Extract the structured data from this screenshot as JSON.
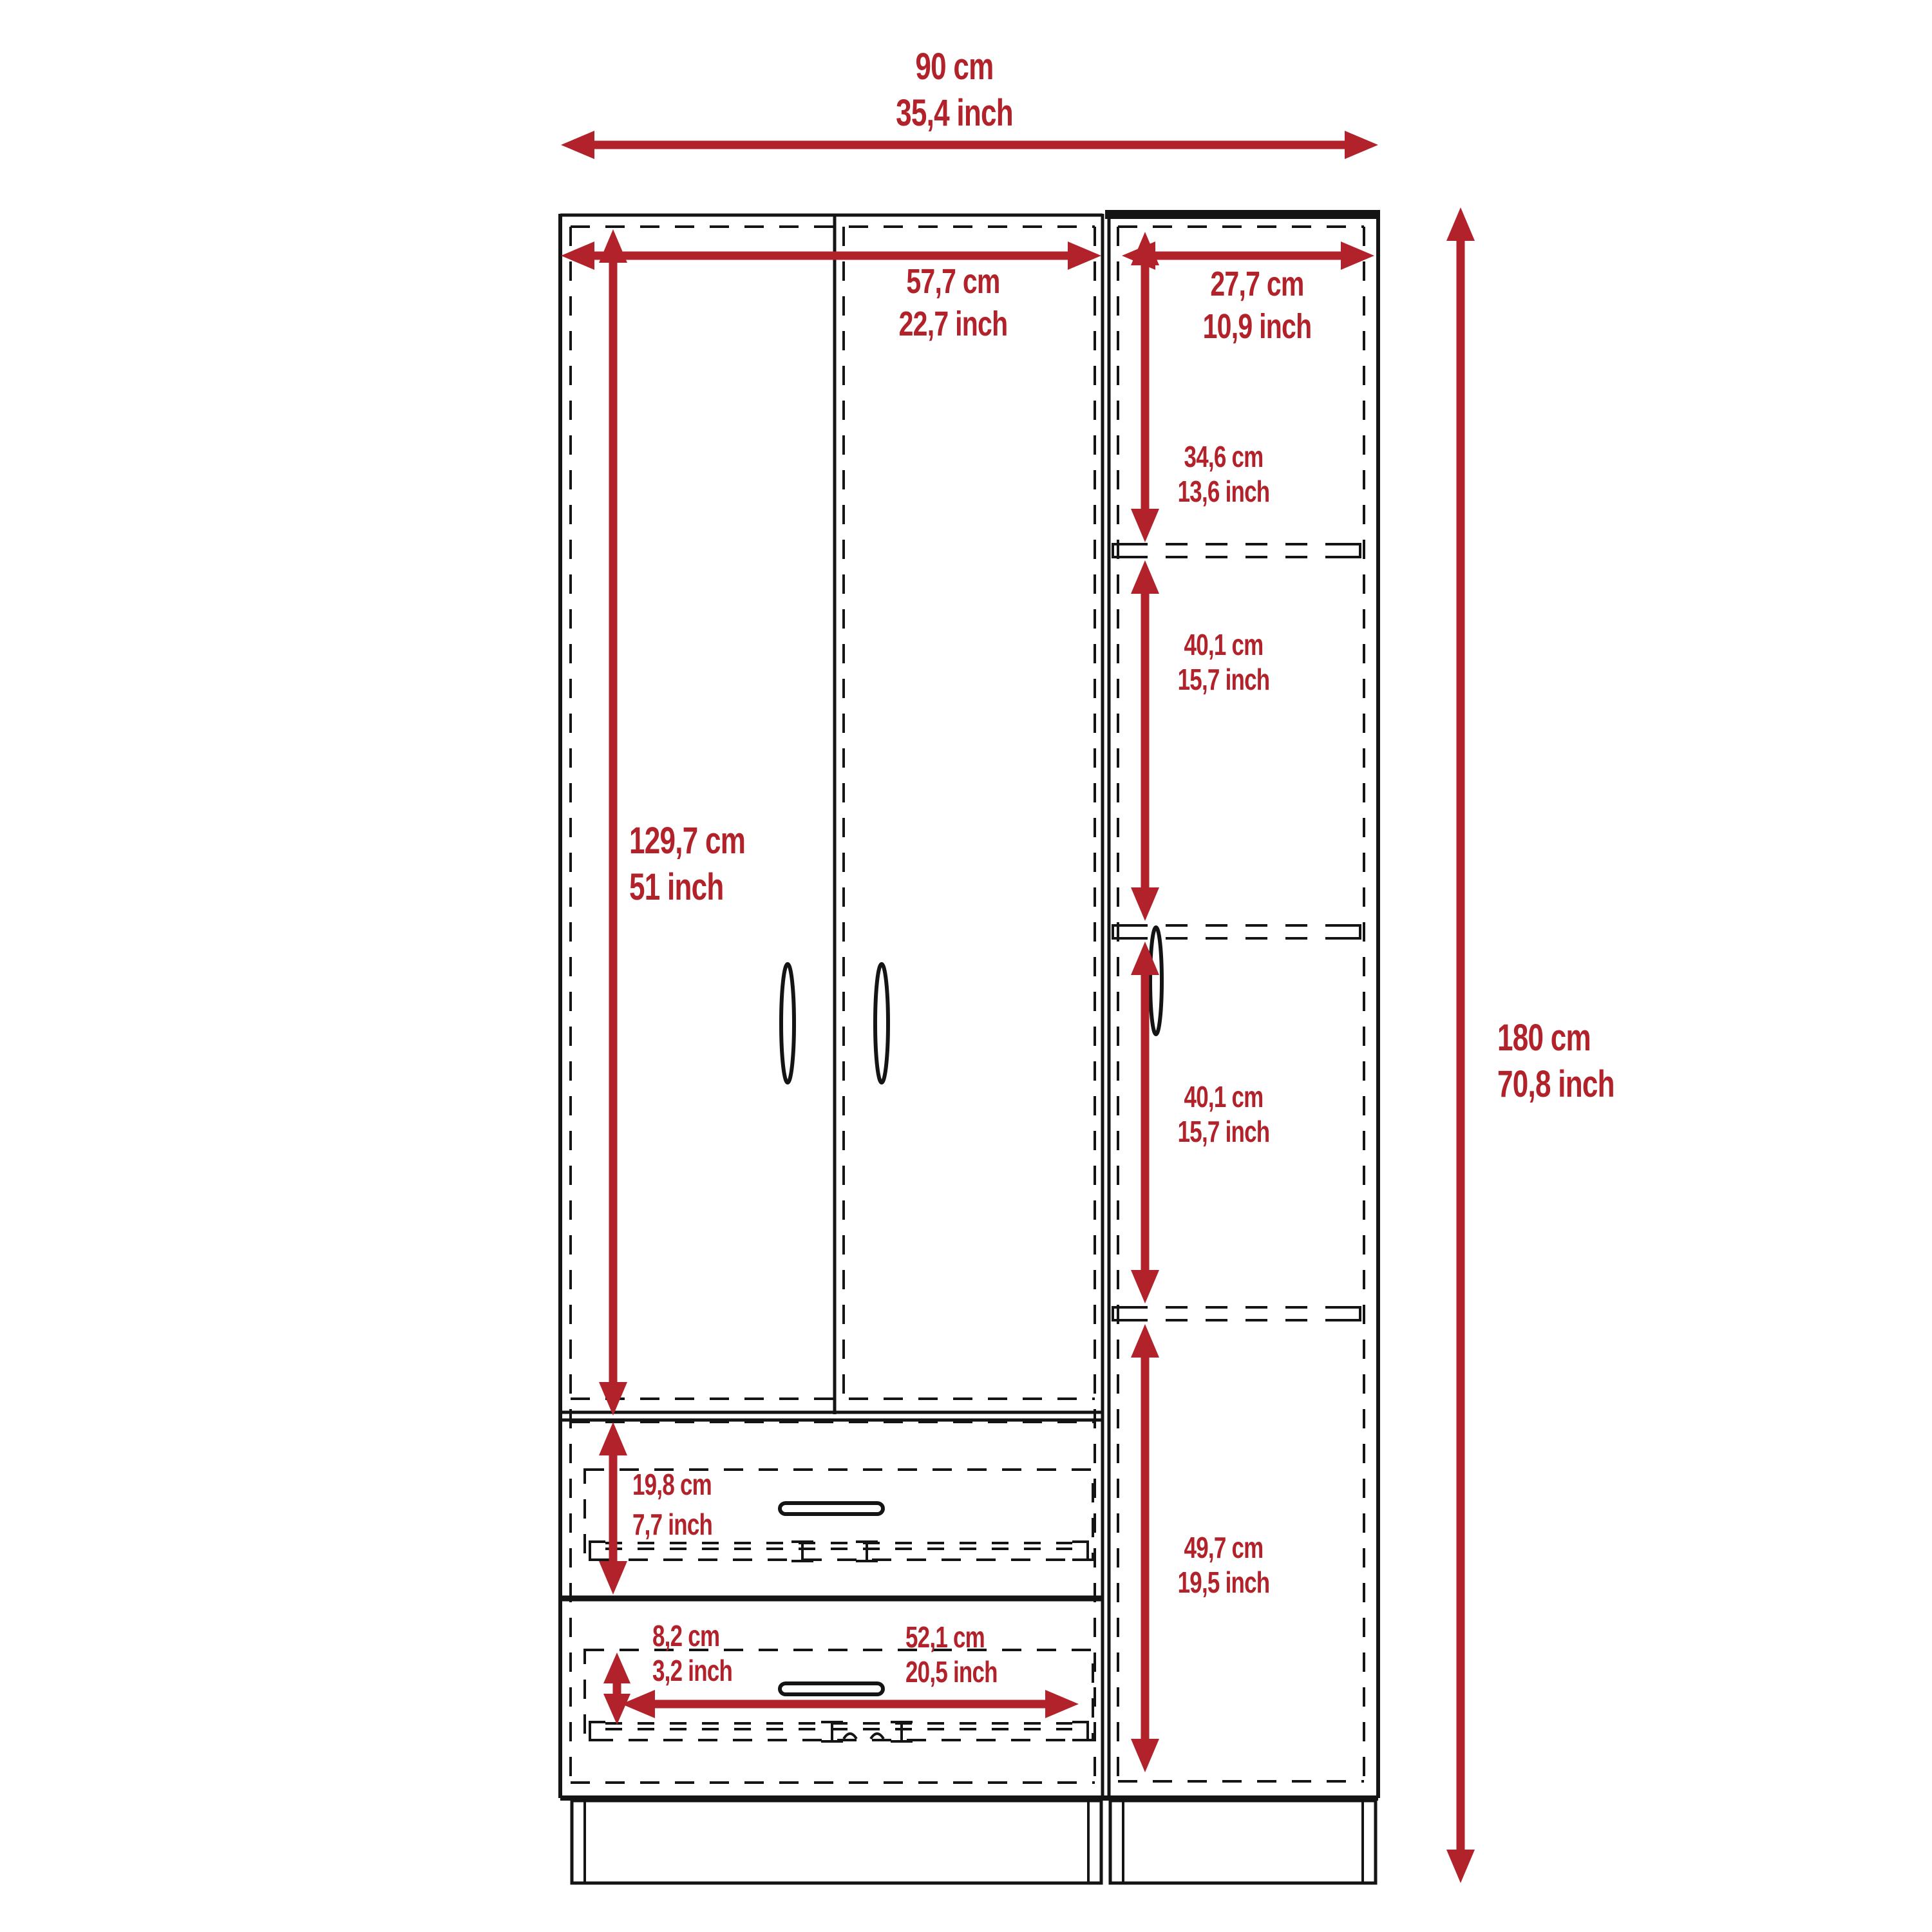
{
  "colors": {
    "accent": "#b2222a",
    "line": "#141414",
    "background": "#ffffff"
  },
  "dimensions": {
    "total_width": {
      "cm": "90 cm",
      "inch": "35,4 inch"
    },
    "left_section_width": {
      "cm": "57,7 cm",
      "inch": "22,7 inch"
    },
    "right_section_width": {
      "cm": "27,7 cm",
      "inch": "10,9 inch"
    },
    "upper_shelf": {
      "cm": "34,6 cm",
      "inch": "13,6 inch"
    },
    "middle_shelf": {
      "cm": "40,1 cm",
      "inch": "15,7 inch"
    },
    "lower_middle_shelf": {
      "cm": "40,1 cm",
      "inch": "15,7 inch"
    },
    "bottom_shelf": {
      "cm": "49,7 cm",
      "inch": "19,5 inch"
    },
    "door_height": {
      "cm": "129,7 cm",
      "inch": "51 inch"
    },
    "total_height": {
      "cm": "180 cm",
      "inch": "70,8 inch"
    },
    "drawer_height": {
      "cm": "19,8 cm",
      "inch": "7,7 inch"
    },
    "bottom_drawer_height": {
      "cm": "8,2 cm",
      "inch": "3,2 inch"
    },
    "drawer_width": {
      "cm": "52,1 cm",
      "inch": "20,5 inch"
    }
  }
}
